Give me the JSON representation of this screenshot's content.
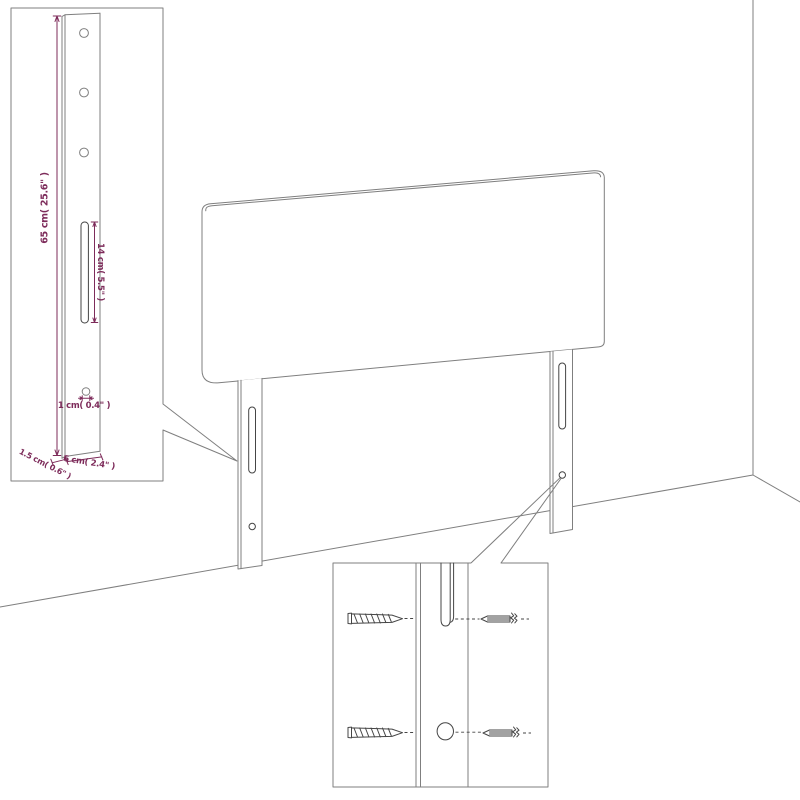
{
  "colors": {
    "background": "#ffffff",
    "line": "#7f7f7f",
    "detail": "#454545",
    "dimension": "#7d2b5a"
  },
  "bracket_detail": {
    "labels": {
      "height": "65 cm( 25.6\" )",
      "slot_length": "14 cm( 5.5\" )",
      "hole_diameter": "1 cm( 0.4\" )",
      "thickness": "1.5 cm( 0.6\" )",
      "width": "6 cm( 2.4\" )"
    }
  },
  "icons": {
    "wood_screw": "wood-screw-icon",
    "machine_screw": "machine-screw-icon",
    "mounting_slot": "slot-icon",
    "screw_hole": "hole-icon"
  }
}
